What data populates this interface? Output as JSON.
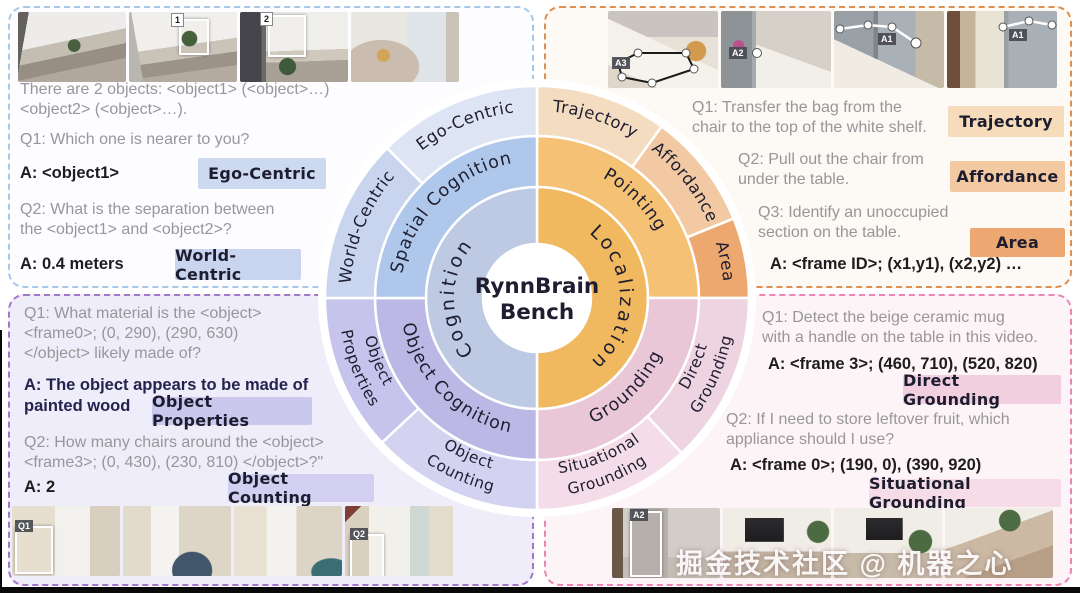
{
  "sunburst": {
    "center": {
      "line1": "RynnBrain",
      "line2": "Bench"
    },
    "rings": [
      {
        "name": "inner",
        "r_in": 54,
        "r_out": 111,
        "text_r": 83,
        "font": 19,
        "letter_spacing": 3,
        "segments": [
          {
            "label": "Localization",
            "color": "#f1b95f",
            "start": 0,
            "end": 180,
            "flip": false
          },
          {
            "label": "Cognition",
            "color": "#bec9e3",
            "start": 180,
            "end": 360,
            "flip": false
          }
        ]
      },
      {
        "name": "middle",
        "r_in": 111,
        "r_out": 162,
        "text_r": 137,
        "font": 17.5,
        "letter_spacing": 1,
        "segments": [
          {
            "label": "Pointing",
            "color": "#f4c175",
            "start": 0,
            "end": 90,
            "flip": false
          },
          {
            "label": "Grounding",
            "color": "#eac7d7",
            "start": 90,
            "end": 180,
            "flip": true
          },
          {
            "label": "Object Cognition",
            "color": "#bcb8e5",
            "start": 180,
            "end": 270,
            "flip": true
          },
          {
            "label": "Spatial Cognition",
            "color": "#aec7ea",
            "start": 270,
            "end": 360,
            "flip": false
          }
        ]
      },
      {
        "name": "outer",
        "r_in": 162,
        "r_out": 212,
        "text_r": 187,
        "font": 16.5,
        "letter_spacing": 0.5,
        "segments": [
          {
            "label": "Trajectory",
            "color": "#f4dcc0",
            "start": 0,
            "end": 36,
            "flip": false
          },
          {
            "label": "Affordance",
            "color": "#f2c9a3",
            "start": 36,
            "end": 68,
            "flip": false
          },
          {
            "label": "Area",
            "color": "#eda86f",
            "start": 68,
            "end": 90,
            "flip": false
          },
          {
            "label": "Direct|Grounding",
            "color": "#eed3e0",
            "start": 90,
            "end": 137,
            "flip": true
          },
          {
            "label": "Situational|Grounding",
            "color": "#f4dde8",
            "start": 137,
            "end": 180,
            "flip": true
          },
          {
            "label": "Object|Counting",
            "color": "#d3d2f1",
            "start": 180,
            "end": 227,
            "flip": true
          },
          {
            "label": "Object|Properties",
            "color": "#c6c3ec",
            "start": 227,
            "end": 270,
            "flip": true
          },
          {
            "label": "World-Centric",
            "color": "#c9d5ef",
            "start": 270,
            "end": 315,
            "flip": false
          },
          {
            "label": "Ego-Centric",
            "color": "#dde4f4",
            "start": 315,
            "end": 360,
            "flip": false
          }
        ]
      }
    ]
  },
  "panels": {
    "top_left": {
      "border_color": "#a6c8ea",
      "intro": "There are 2 objects: <object1> (<object>…)\n<object2> (<object>…).",
      "q1": "Q1: Which one is nearer to you?",
      "a1": "A: <object1>",
      "badge1": "Ego-Centric",
      "badge1_color": "#cdd8f1",
      "q2": "Q2: What is the separation between\nthe <object1> and <object2>?",
      "a2": "A: 0.4 meters",
      "badge2": "World-Centric",
      "badge2_color": "#c9d4ee",
      "frames": [
        {},
        {
          "ann": "1"
        },
        {
          "ann": "2"
        },
        {}
      ]
    },
    "top_right": {
      "border_color": "#df9051",
      "q1": "Q1: Transfer the bag from the\nchair to the top of the white shelf.",
      "badge1": "Trajectory",
      "badge1_color": "#f6dcba",
      "q2": "Q2: Pull out the chair from\nunder the table.",
      "badge2": "Affordance",
      "badge2_color": "#f3c9a2",
      "q3": "Q3: Identify an unoccupied\nsection on the table.",
      "badge3": "Area",
      "badge3_color": "#eda771",
      "answer": "A: <frame ID>; (x1,y1), (x2,y2) …",
      "frames": [
        {
          "ann": "A3"
        },
        {
          "ann": "A2"
        },
        {
          "ann": "A1"
        },
        {
          "ann": "A1"
        }
      ]
    },
    "bottom_left": {
      "border_color": "#a478c9",
      "q1": "Q1: What material is the <object>\n<frame0>; (0, 290), (290, 630)\n</object> likely made of?",
      "a1": "A: The object appears to be made of\npainted wood",
      "badge1": "Object Properties",
      "badge1_color": "#cbc8ee",
      "q2": "Q2: How many chairs around the <object>\n<frame3>; (0, 430), (230, 810) </object>?\"",
      "a2": "A: 2",
      "badge2": "Object Counting",
      "badge2_color": "#d2cff0",
      "frames": [
        {
          "ann": "Q1"
        },
        {},
        {},
        {
          "ann": "Q2"
        }
      ]
    },
    "bottom_right": {
      "border_color": "#ec84b6",
      "q1": "Q1: Detect the beige ceramic mug\nwith a handle on the table in this video.",
      "a1": "A: <frame 3>; (460, 710), (520, 820)",
      "badge1": "Direct Grounding",
      "badge1_color": "#f2cfdf",
      "q2": "Q2: If I need to store leftover fruit, which\nappliance should I use?",
      "a2": "A: <frame 0>; (190, 0), (390, 920)",
      "badge2": "Situational Grounding",
      "badge2_color": "#f6dce7",
      "watermark": "掘金技术社区 @ 机器之心",
      "frames": [
        {
          "ann": "A2"
        },
        {},
        {},
        {}
      ]
    }
  },
  "colors": {
    "question_text": "#97979a",
    "answer_text": "#1d1d1f",
    "answer_navy": "#23234d",
    "ring_text": "#1e1e30",
    "background": "#ffffff"
  }
}
